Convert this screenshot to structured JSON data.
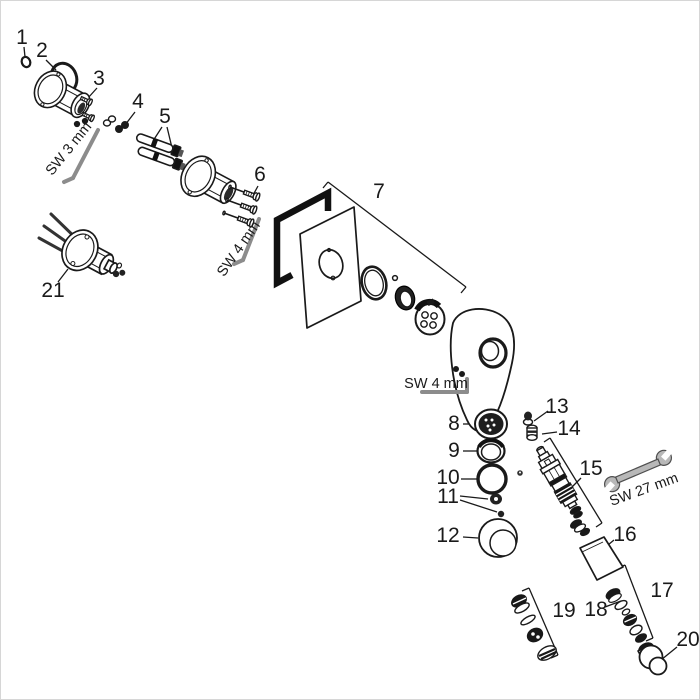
{
  "diagram": {
    "kind": "exploded-parts-diagram",
    "colors": {
      "background": "#ffffff",
      "line": "#1a1a1a",
      "wrench": "#b8b8b8"
    },
    "part_labels": [
      "1",
      "2",
      "3",
      "4",
      "5",
      "6",
      "7",
      "8",
      "9",
      "10",
      "11",
      "12",
      "13",
      "14",
      "15",
      "16",
      "17",
      "18",
      "19",
      "20",
      "21"
    ],
    "tool_labels": {
      "sw3": "SW 3 mm",
      "sw4_upper": "SW 4 mm",
      "sw4_handle": "SW 4 mm",
      "sw27": "SW 27 mm"
    }
  }
}
